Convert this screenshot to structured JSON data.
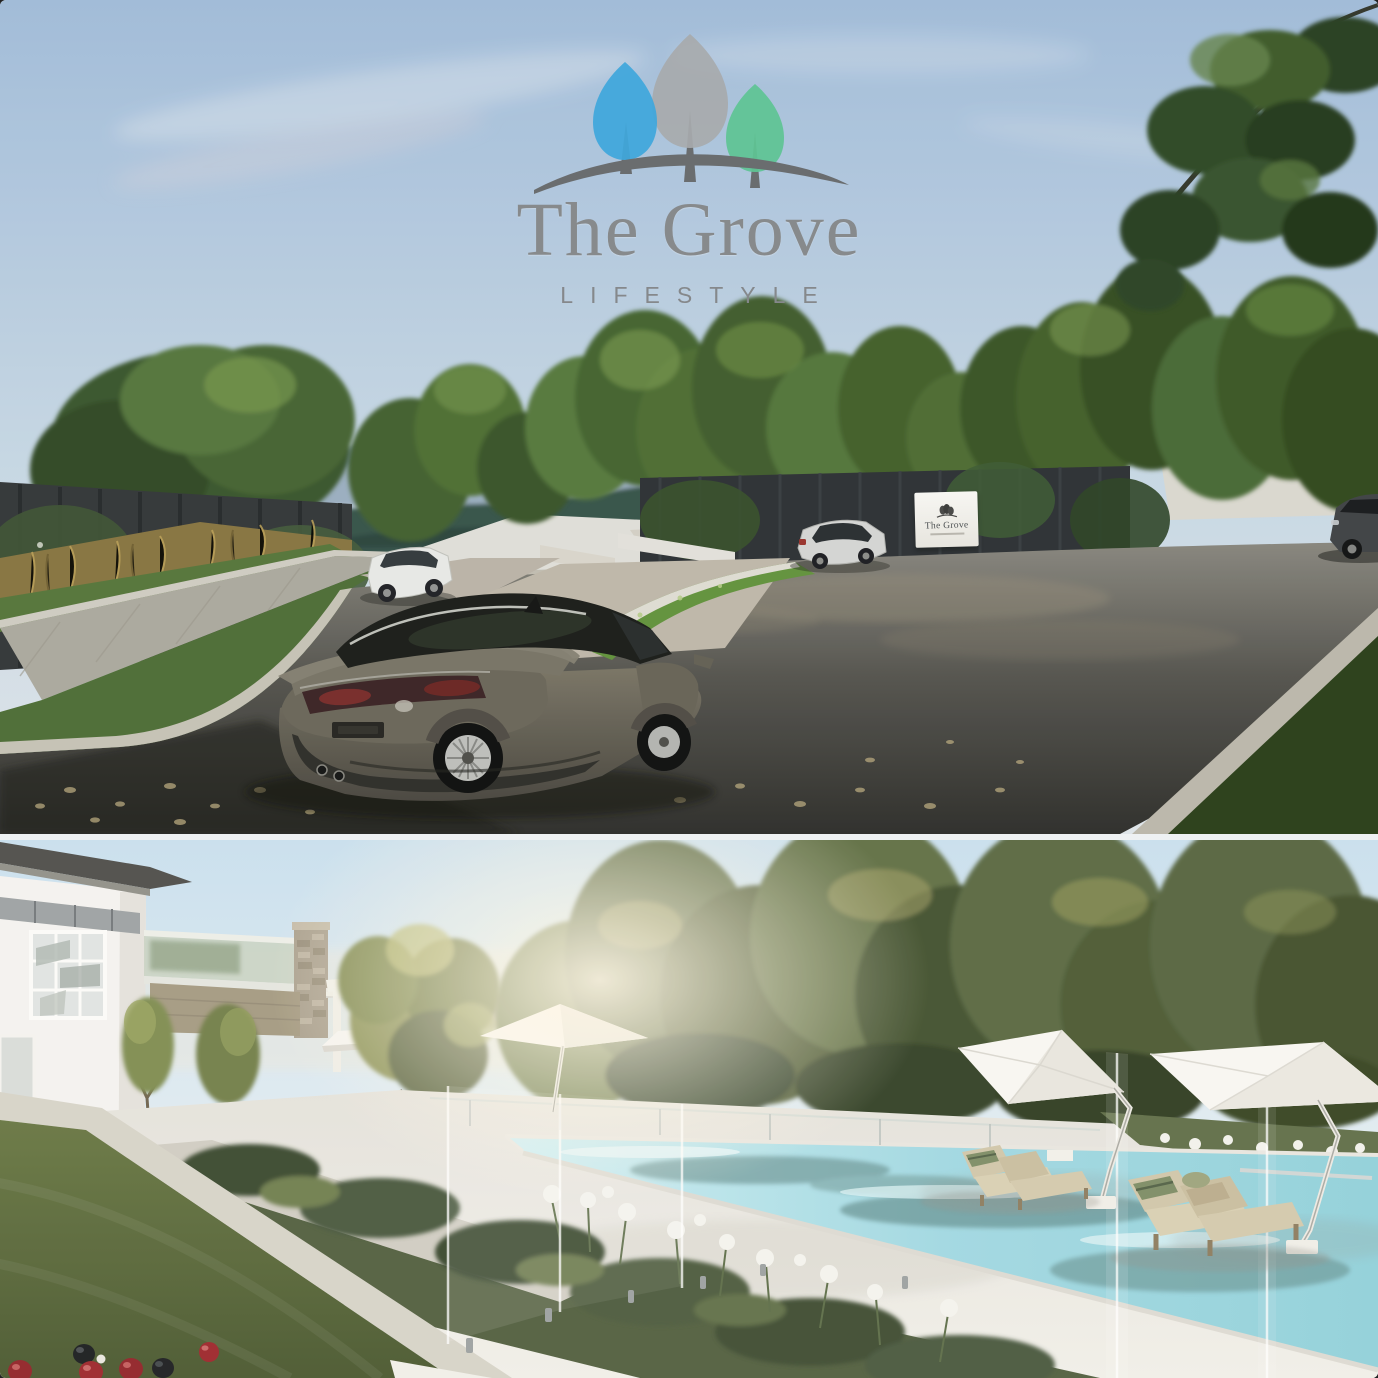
{
  "collage": {
    "panels": 2,
    "divider_color": "#EEF1F3"
  },
  "logo": {
    "title": "The Grove",
    "subtitle": "LIFESTYLE",
    "tree_blue": "#3FA7DC",
    "tree_grey": "#A7AAAC",
    "tree_green": "#5FC493",
    "hill_grey": "#6A6D6F",
    "text_grey": "#8A8D8F"
  },
  "sign": {
    "line1": "The Grove"
  },
  "top_panel": {
    "description": "Street scene render: grey sedan parked on new asphalt road, white wagon and silver hatchback beyond, dark timber fences, street trees, distant blue mountain range, The Grove entry sign",
    "palette": {
      "sky": "#ADC6E2",
      "mountains": "#87A0B8",
      "forest_ridge": "#3D5A50",
      "road": "#4A4845",
      "grass": "#55743C",
      "native_grass": "#97823F",
      "footpath": "#B4B0A5"
    }
  },
  "bottom_panel": {
    "description": "Resort amenities render: white clubhouse, stone pillar and pergola, long lap pool behind frameless glass fencing, white cantilever umbrellas, timber sun loungers, bowling green with red and black lawn bowls",
    "palette": {
      "sky": "#D4E4EE",
      "forest": "#4C5C35",
      "pool": "#9ED8E2",
      "deck": "#ECEAE5",
      "lawn": "#5A6B3C",
      "stone": "#A89E8C"
    },
    "bowls": {
      "red_count": 4,
      "black_count": 2,
      "jack_count": 1
    }
  }
}
